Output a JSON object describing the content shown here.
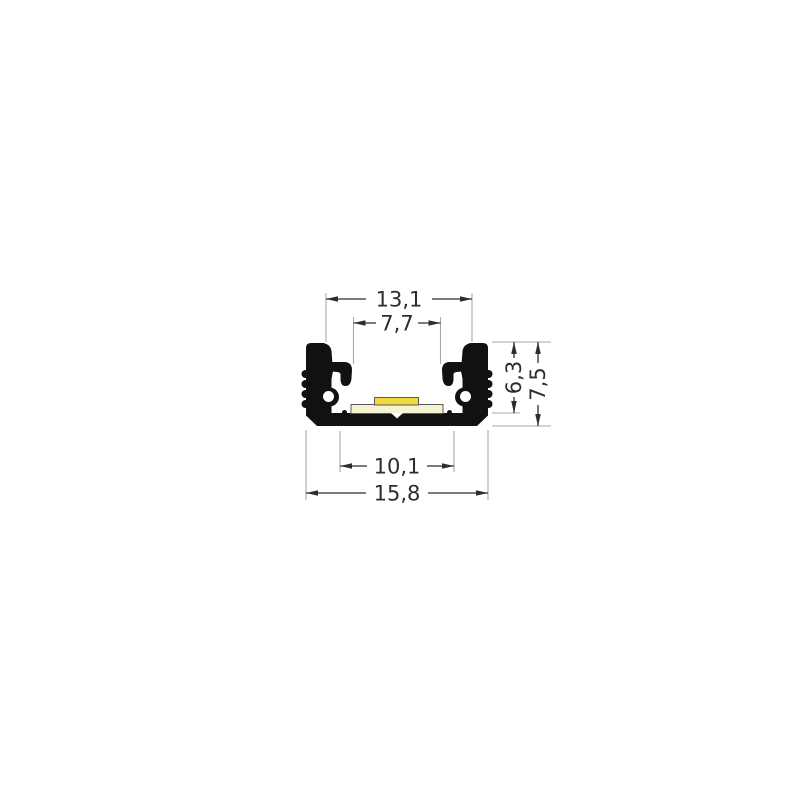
{
  "colors": {
    "background": "#ffffff",
    "profile": "#111111",
    "pcb": "#f6f3d2",
    "led": "#f2d93e",
    "dimension_line": "#2d2d2d",
    "extension_line": "#a8a8a8"
  },
  "dimensions": {
    "top_width": {
      "label": "13,1",
      "value": 13.1,
      "orientation": "horizontal"
    },
    "opening_width": {
      "label": "7,7",
      "value": 7.7,
      "orientation": "horizontal"
    },
    "inner_height": {
      "label": "6,3",
      "value": 6.3,
      "orientation": "vertical"
    },
    "total_height": {
      "label": "7,5",
      "value": 7.5,
      "orientation": "vertical"
    },
    "inner_bottom_width": {
      "label": "10,1",
      "value": 10.1,
      "orientation": "horizontal"
    },
    "total_width": {
      "label": "15,8",
      "value": 15.8,
      "orientation": "horizontal"
    }
  }
}
